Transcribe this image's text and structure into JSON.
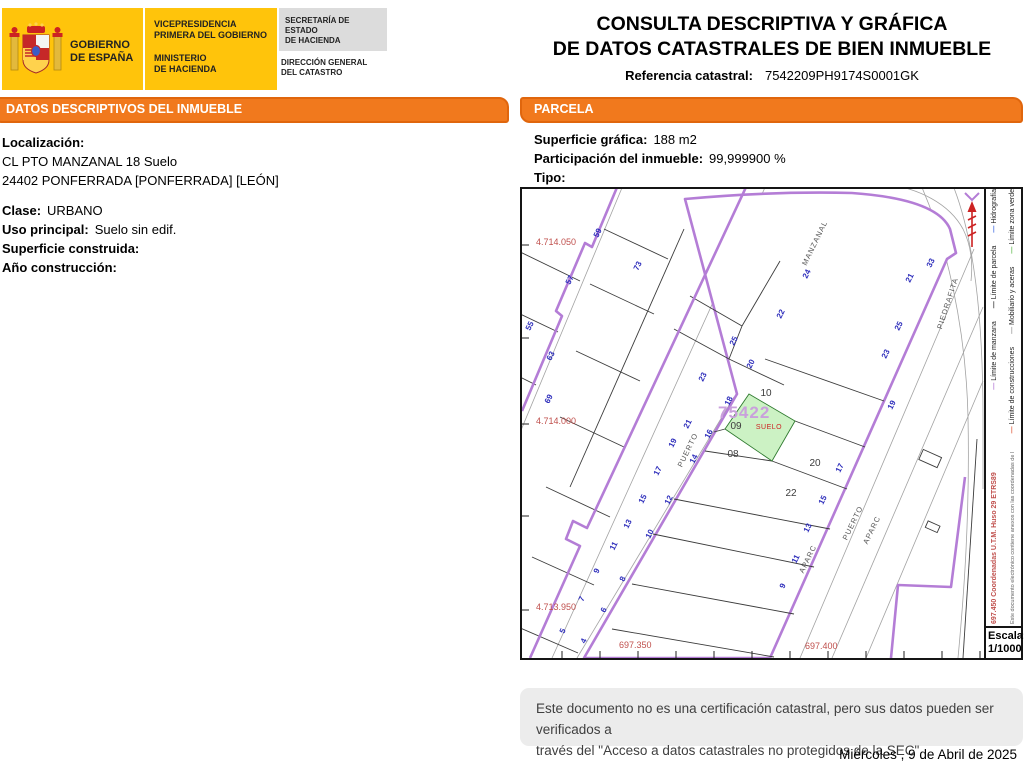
{
  "header": {
    "gobierno": "GOBIERNO\nDE ESPAÑA",
    "vicepresidencia": "VICEPRESIDENCIA\nPRIMERA DEL GOBIERNO",
    "ministerio": "MINISTERIO\nDE HACIENDA",
    "secretaria": "SECRETARÍA DE ESTADO\nDE HACIENDA",
    "direccion_general": "DIRECCIÓN GENERAL\nDEL CATASTRO",
    "title_line1": "CONSULTA DESCRIPTIVA Y GRÁFICA",
    "title_line2": "DE DATOS CATASTRALES DE BIEN INMUEBLE",
    "ref_label": "Referencia catastral:",
    "ref_value": "7542209PH9174S0001GK"
  },
  "datos": {
    "header": "DATOS DESCRIPTIVOS DEL INMUEBLE",
    "localizacion_label": "Localización:",
    "direccion1": "CL PTO MANZANAL 18 Suelo",
    "direccion2": "24402 PONFERRADA [PONFERRADA] [LEÓN]",
    "clase_label": "Clase:",
    "clase": "URBANO",
    "uso_label": "Uso principal:",
    "uso": "Suelo sin edif.",
    "superficie_label": "Superficie construida:",
    "superficie": "",
    "anio_label": "Año construcción:",
    "anio": ""
  },
  "parcela": {
    "header": "PARCELA",
    "superficie_label": "Superficie gráfica:",
    "superficie": "188 m2",
    "participacion_label": "Participación del inmueble:",
    "participacion": "99,999900 %",
    "tipo_label": "Tipo:",
    "tipo": ""
  },
  "map": {
    "manzana_number": "75422",
    "highlight_label": "SUELO",
    "colors": {
      "boundary_purple": "#b47dd6",
      "highlight_green": "#ccf2c4",
      "house_number_blue": "#2d2dbb",
      "coordinate_red": "#c0504d"
    },
    "labels": [
      [
        "55",
        10,
        138,
        "blu",
        -64
      ],
      [
        "57",
        50,
        92,
        "blu",
        -64
      ],
      [
        "59",
        78,
        45,
        "blu",
        -64
      ],
      [
        "63",
        31,
        168,
        "blu",
        -64
      ],
      [
        "69",
        29,
        211,
        "blu",
        -64
      ],
      [
        "73",
        118,
        78,
        "blu",
        -64
      ],
      [
        "5",
        43,
        443,
        "blu",
        -64
      ],
      [
        "7",
        62,
        411,
        "blu",
        -64
      ],
      [
        "9",
        77,
        383,
        "blu",
        -64
      ],
      [
        "11",
        94,
        358,
        "blu",
        -64
      ],
      [
        "13",
        108,
        336,
        "blu",
        -64
      ],
      [
        "15",
        123,
        311,
        "blu",
        -64
      ],
      [
        "17",
        138,
        283,
        "blu",
        -64
      ],
      [
        "19",
        153,
        255,
        "blu",
        -64
      ],
      [
        "21",
        168,
        236,
        "blu",
        -64
      ],
      [
        "4",
        64,
        453,
        "blu",
        -64
      ],
      [
        "6",
        84,
        422,
        "blu",
        -64
      ],
      [
        "8",
        103,
        391,
        "blu",
        -64
      ],
      [
        "10",
        130,
        346,
        "blu",
        -64
      ],
      [
        "12",
        149,
        312,
        "blu",
        -64
      ],
      [
        "14",
        174,
        271,
        "blu",
        -64
      ],
      [
        "16",
        189,
        246,
        "blu",
        -64
      ],
      [
        "18",
        209,
        213,
        "blu",
        -64
      ],
      [
        "20",
        231,
        176,
        "blu",
        -64
      ],
      [
        "25",
        214,
        153,
        "blu",
        -64
      ],
      [
        "23",
        183,
        189,
        "blu",
        -64
      ],
      [
        "24",
        287,
        86,
        "blu",
        -64
      ],
      [
        "22",
        261,
        126,
        "blu",
        -64
      ],
      [
        "33",
        411,
        75,
        "blu",
        -64
      ],
      [
        "21",
        390,
        90,
        "blu",
        -64
      ],
      [
        "25",
        379,
        138,
        "blu",
        -64
      ],
      [
        "23",
        366,
        166,
        "blu",
        -64
      ],
      [
        "19",
        372,
        217,
        "blu",
        -64
      ],
      [
        "17",
        320,
        280,
        "blu",
        -64
      ],
      [
        "15",
        303,
        312,
        "blu",
        -64
      ],
      [
        "13",
        288,
        340,
        "blu",
        -64
      ],
      [
        "11",
        276,
        371,
        "blu",
        -64
      ],
      [
        "9",
        263,
        398,
        "blu",
        -64
      ],
      [
        "10",
        244,
        207,
        "pnum",
        0
      ],
      [
        "09",
        214,
        240,
        "pnum",
        0
      ],
      [
        "08",
        211,
        268,
        "pnum",
        0
      ],
      [
        "20",
        293,
        277,
        "pnum",
        0
      ],
      [
        "22",
        269,
        307,
        "pnum",
        0
      ],
      [
        "4.714.050",
        14,
        56,
        "red",
        0
      ],
      [
        "4.714.000",
        14,
        235,
        "red",
        0
      ],
      [
        "4.713.950",
        14,
        421,
        "red",
        0
      ],
      [
        "697.350",
        97,
        459,
        "red",
        0
      ],
      [
        "697.400",
        283,
        460,
        "red",
        0
      ],
      [
        "MANZANAL",
        295,
        55,
        "str",
        -64
      ],
      [
        "PUERTO",
        168,
        262,
        "str",
        -64
      ],
      [
        "PUERTO",
        333,
        335,
        "str",
        -64
      ],
      [
        "APARC",
        352,
        342,
        "str",
        -64
      ],
      [
        "APARC",
        288,
        371,
        "str",
        -64
      ],
      [
        "PIEDRAFITA",
        428,
        115,
        "str",
        -72
      ],
      [
        "75422",
        196,
        229,
        "mz",
        0
      ],
      [
        "SUELO",
        247,
        240,
        "su",
        0
      ]
    ]
  },
  "legend": {
    "row1": [
      {
        "label": "Límite de manzana",
        "color": "#b47dd6"
      },
      {
        "label": "Límite de parcela",
        "color": "#333333"
      },
      {
        "label": "Hidrografía",
        "color": "#4169e1"
      }
    ],
    "row2": [
      {
        "label": "Límite de construcciones",
        "color": "#e06040"
      },
      {
        "label": "Mobiliario y aceras",
        "color": "#9a9a9a"
      },
      {
        "label": "Límite zona verde",
        "color": "#66bb55"
      }
    ],
    "coords_note": "697.450 Coordenadas U.T.M. Huso 29 ETRS89",
    "doc_note": "Este documento electrónico contiene anexos con las coordenadas de los vértices UTM de la parcela y los datos de la certificación",
    "escala_label": "Escala:",
    "escala_value": "1/1000"
  },
  "footer": {
    "disclaimer1": "Este documento no es una certificación catastral, pero sus datos pueden ser verificados a",
    "disclaimer2": "través del \"Acceso a datos catastrales no protegidos de la SEC\"",
    "date": "Miércoles , 9 de Abril de 2025"
  }
}
